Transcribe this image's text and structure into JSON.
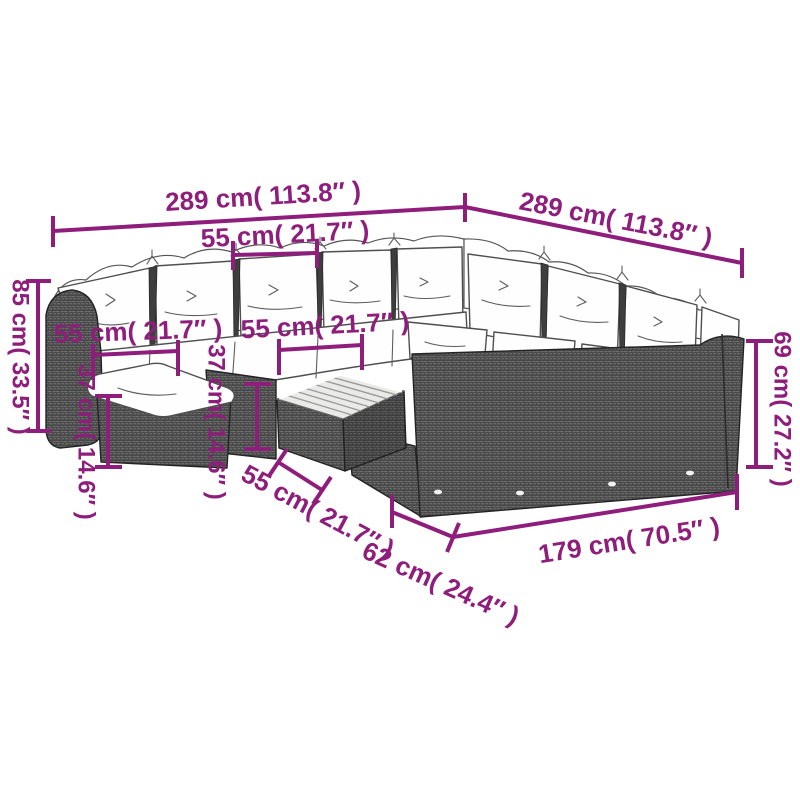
{
  "diagram": {
    "type": "product-dimension-diagram",
    "subject": "poly-rattan garden corner sofa set with cushions, footstool and slatted coffee table",
    "background_color": "#ffffff",
    "accent_color": "#8e1d7c",
    "furniture_dark_color": "#4b4b4b",
    "cushion_color": "#fefefe"
  },
  "labels": {
    "back_width_left": "289 cm( 113.8″ )",
    "back_width_right": "289 cm( 113.8″ )",
    "seat_width_top": "55 cm( 21.7″ )",
    "total_height_left": "85 cm( 33.5″ )",
    "seat_width_mid_left": "55 cm( 21.7″ )",
    "seat_width_mid_right": "55 cm( 21.7″ )",
    "footstool_height": "37 cm( 14.6″ )",
    "table_height": "37 cm( 14.6″ )",
    "table_depth_bottom": "55 cm( 21.7″ )",
    "side_depth_bottom": "62 cm( 24.4″ )",
    "front_width_bottom": "179 cm( 70.5″ )",
    "seat_height_right": "69 cm( 27.2″ )"
  }
}
